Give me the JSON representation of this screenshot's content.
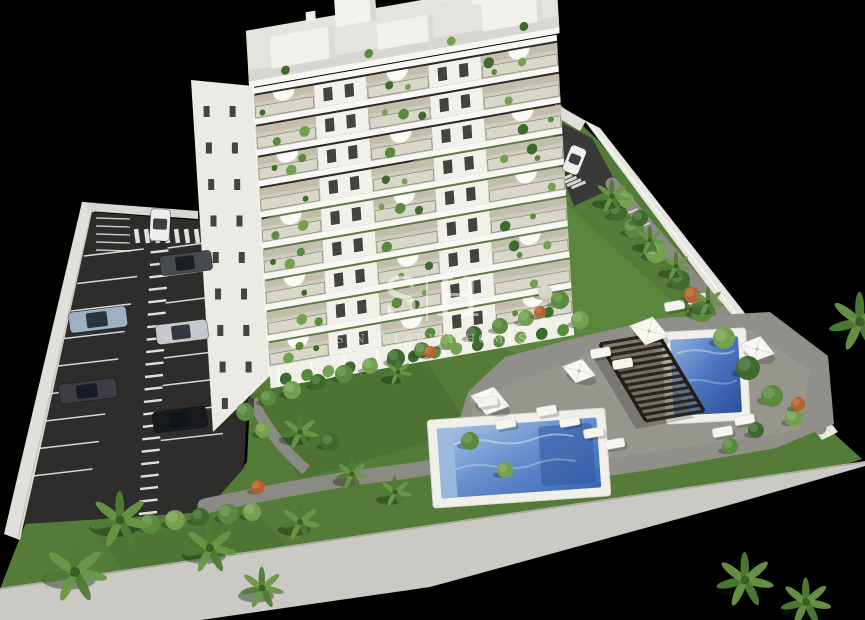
{
  "watermark": {
    "monogram_left": "S",
    "monogram_right": "H",
    "wordmark": "SINGULARITY HOMES"
  },
  "scene": {
    "background": "#000000",
    "building_floors": 10,
    "cars_in_parking": 6,
    "cars_at_entrance": 1,
    "pools": 2,
    "umbrellas": 4,
    "sun_loungers": 12,
    "pergolas": 1
  },
  "palette": {
    "background": "#000000",
    "building_white": "#f2f0ea",
    "building_side": "#eceae4",
    "roof_gravel": "#d7d6d0",
    "balcony_stone": "#cfccbb",
    "window_glass": "#45443c",
    "lawn_green": "#547c38",
    "lawn_light": "#6f9a4c",
    "lawn_dark": "#3f6128",
    "asphalt": "#2e2d2c",
    "road_dark": "#393937",
    "line_white": "#f3f3f0",
    "pool_frame": "#f0efe9",
    "pool_water_light": "#a9c4e4",
    "pool_water_deep": "#3b66b5",
    "deck_gray": "#908f89",
    "path_gray": "#8b8a85",
    "sidewalk_gray": "#cac9c4",
    "wall_white": "#e3e2dd",
    "pergola_dark": "#26221b",
    "plant_green_dark": "#3f6a2e",
    "plant_green_mid": "#5a8a3e",
    "plant_green_light": "#74a050",
    "plant_orange": "#b5622f",
    "car_colors": [
      "#eceded",
      "#474a4e",
      "#9db1c5",
      "#c6c9cc",
      "#3c3e44",
      "#17191c"
    ]
  }
}
